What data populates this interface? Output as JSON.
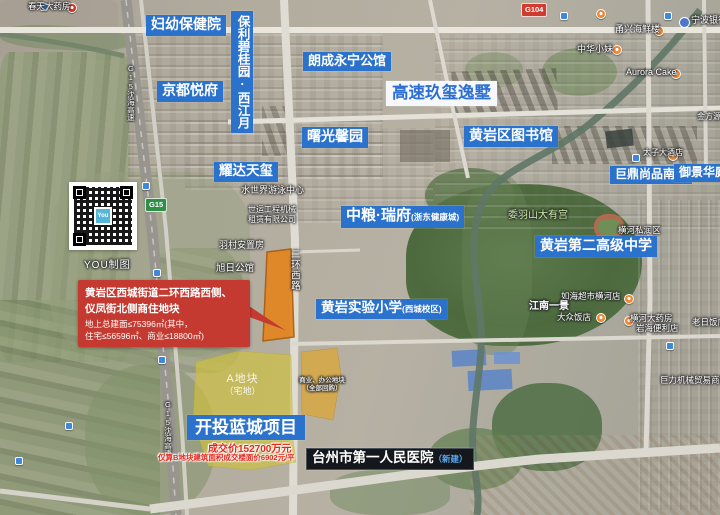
{
  "colors": {
    "label_blue": "#2b72cc",
    "label_white_bg": "#f6f8fb",
    "label_white_text": "#2d6fd2",
    "label_dark": "#14171c",
    "annotation_red": "#c43a30",
    "price_red": "#e8251c",
    "parcel_orange": "#e2851f",
    "parcel_yellow": "#cfc13f",
    "parcel_commercial": "#d9a83c"
  },
  "labels": {
    "fuyou": "妇幼保健院",
    "baoli": "保利碧桂园·西江月",
    "langcheng": "朗成永宁公馆",
    "jingdu": "京都悦府",
    "gaosu": "高速玖玺逸墅",
    "shuguang": "曙光馨园",
    "library": "黄岩区图书馆",
    "yaoda": "耀达天玺",
    "zhongliang": {
      "name": "中粮·瑞府",
      "suffix": "(浙东健康城)"
    },
    "juding": "巨鼎尚品南郡",
    "yujing": "御景华庭",
    "gaozhong": "黄岩第二高级中学",
    "shiyan": {
      "name": "黄岩实验小学",
      "suffix": "(西城校区)"
    },
    "kaitou": "开投蓝城项目",
    "hospital": {
      "name": "台州市第一人民医院",
      "suffix": "（新建）"
    }
  },
  "annotation": {
    "line1": "黄岩区西城街道二环西路西侧、",
    "line2": "仪凤街北侧商住地块",
    "line3": "地上总建面≤75396㎡(其中，",
    "line4": "住宅≤56596㎡、商业≤18800㎡)"
  },
  "deal": {
    "price": "成交价152700万元",
    "floor_price": "仅算B地块建筑面积成交楼面价6902元/平"
  },
  "parcels": {
    "a_line1": "A地块",
    "a_line2": "（宅地）",
    "c_line1": "商业、办公地块",
    "c_line2": "（全部回购）"
  },
  "roads": {
    "g104": "G104",
    "g15": "G15",
    "erhuan": "二环西路",
    "shenhai": "G15沈海高速"
  },
  "map_texts": {
    "chuntian": "春天大药房",
    "yongxing": "甬兴海鲜楼",
    "zhonghua": "中华小妹",
    "ningbo": "宁波银行",
    "aurora": "Aurora Cake",
    "jinfang": "金方源",
    "taizi": "太子大酒店",
    "shuishijie": "水世界游泳中心",
    "shiyun1": "世运工程机械",
    "shiyun2": "租赁有限公司",
    "yucun": "羽村安置房",
    "xuri": "旭日公馆",
    "weiyushan": "委羽山大有宫",
    "henghe": "横河私润区",
    "ruhai": "如海超市横河店",
    "jiangnan": "江南一景",
    "dazhong": "大众饭店",
    "hengheyao": "横河大药房",
    "yanhai": "岩海便利店",
    "laori": "老日饭店",
    "juli": "巨力机械贸易商行"
  },
  "qr": {
    "logo": "You",
    "caption": "YOU制图"
  }
}
